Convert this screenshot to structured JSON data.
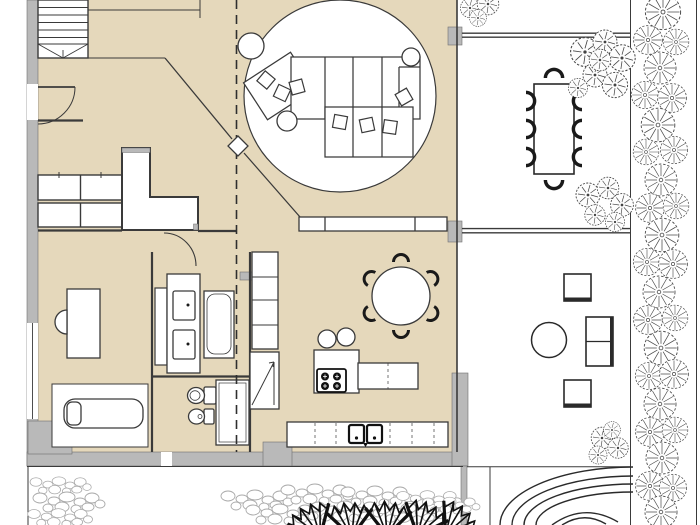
{
  "document": {
    "kind": "architectural-floor-plan",
    "visible_text": []
  },
  "colors": {
    "background": "#ffffff",
    "floor_fill": "#e5d8bb",
    "wall_fill": "#b9b9b9",
    "line": "#3a3a3a",
    "furniture_fill": "#ffffff",
    "furniture_dark": "#1a1a1a",
    "pebble_stroke": "#a9a9a9",
    "vegetation_stroke": "#4b4b4b"
  },
  "inventory": {
    "indoor": [
      "staircase",
      "entry-door",
      "hallway-cabinets",
      "wardrobe-partition",
      "column-diamond",
      "section-dashed-line",
      "round-rug",
      "modular-sofa",
      "sofa-cushions",
      "side-tables",
      "sideboard",
      "desk",
      "desk-chair",
      "rug",
      "daybed",
      "vanity-double-sink",
      "bathtub",
      "toilet",
      "bidet",
      "shower",
      "tall-cabinets",
      "refrigerator",
      "kitchen-island",
      "cooktop",
      "bar-stools",
      "round-dining-table",
      "dining-chairs",
      "kitchen-counter",
      "double-sink"
    ],
    "outdoor": [
      "patio-dining-table",
      "patio-chairs",
      "lounge-armchairs",
      "lounge-sofa",
      "lounge-round-table",
      "trees",
      "shrubs",
      "hedge-strip",
      "pebble-garden",
      "fan-palms",
      "curved-garden-paths"
    ]
  }
}
